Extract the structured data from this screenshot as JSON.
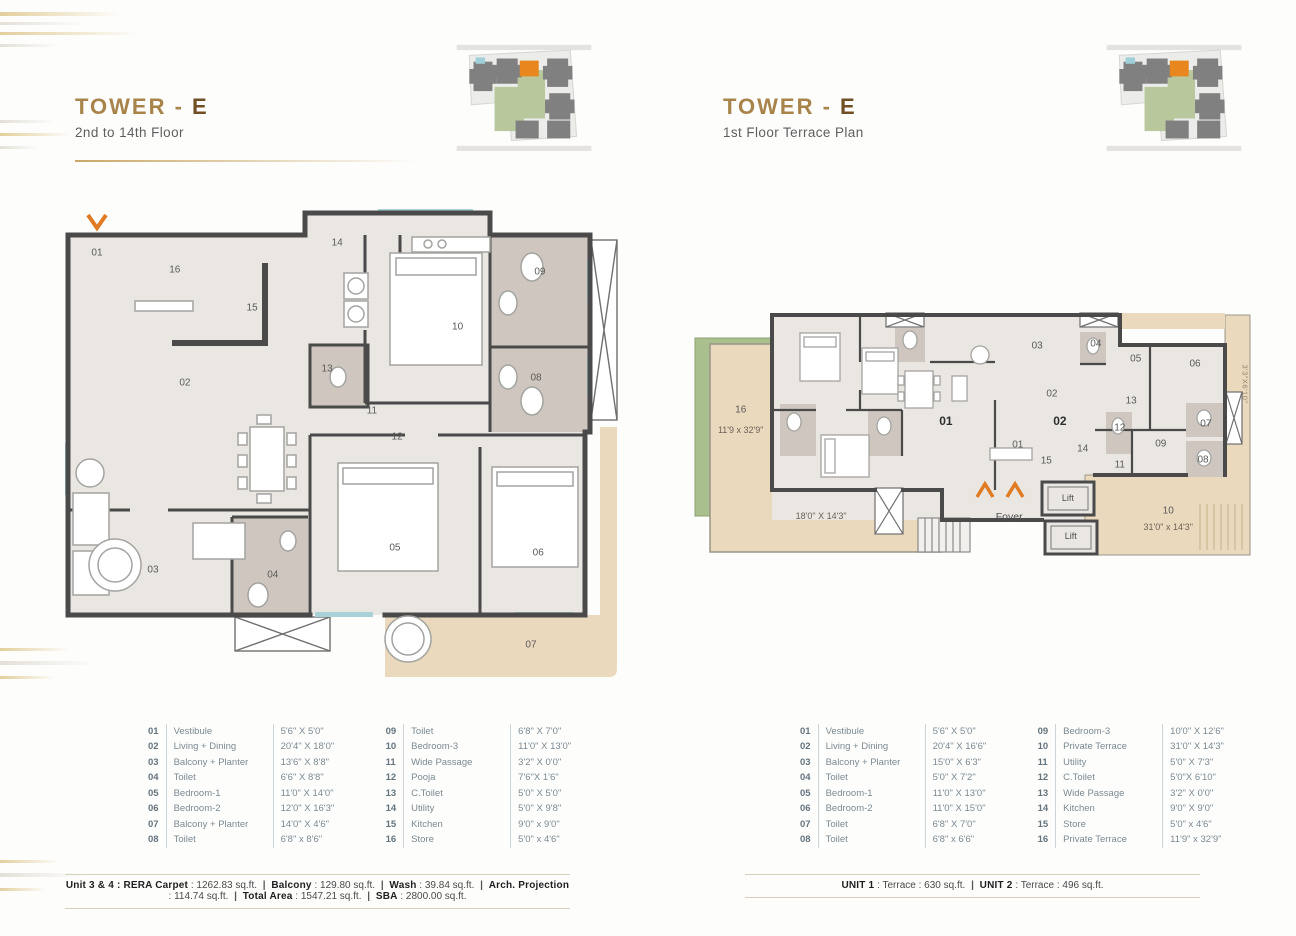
{
  "colors": {
    "accent_gold": "#a8834a",
    "tower_highlight_orange": "#e8871e",
    "entry_arrow_orange": "#e07b24",
    "terrace_beige": "#ebd9bd",
    "planter_green": "#a9bf8d",
    "toilet_taupe": "#cfc7bf",
    "wall_gray": "#4a4a4a"
  },
  "left": {
    "title": {
      "prefix": "TOWER - ",
      "tower": "E"
    },
    "subtitle": "2nd to 14th Floor",
    "plan_labels": [
      {
        "t": "01",
        "x": 6.6,
        "y": 9.8
      },
      {
        "t": "16",
        "x": 20.5,
        "y": 13.3
      },
      {
        "t": "15",
        "x": 34.3,
        "y": 21.0
      },
      {
        "t": "14",
        "x": 49.5,
        "y": 7.8
      },
      {
        "t": "10",
        "x": 71.0,
        "y": 24.9
      },
      {
        "t": "09",
        "x": 85.7,
        "y": 13.7
      },
      {
        "t": "08",
        "x": 85.0,
        "y": 35.3
      },
      {
        "t": "13",
        "x": 47.7,
        "y": 33.5
      },
      {
        "t": "02",
        "x": 22.3,
        "y": 36.3
      },
      {
        "t": "11",
        "x": 55.7,
        "y": 42.0
      },
      {
        "t": "12",
        "x": 60.2,
        "y": 47.3
      },
      {
        "t": "05",
        "x": 59.8,
        "y": 70.0
      },
      {
        "t": "06",
        "x": 85.4,
        "y": 71.0
      },
      {
        "t": "03",
        "x": 16.6,
        "y": 74.5
      },
      {
        "t": "04",
        "x": 38.0,
        "y": 75.5
      },
      {
        "t": "07",
        "x": 84.1,
        "y": 89.8
      }
    ],
    "legend": {
      "col1": [
        {
          "no": "01",
          "name": "Vestibule",
          "dim": "5'6\" X 5'0\""
        },
        {
          "no": "02",
          "name": "Living + Dining",
          "dim": "20'4\" X 18'0\""
        },
        {
          "no": "03",
          "name": "Balcony + Planter",
          "dim": "13'6\" X 8'8\""
        },
        {
          "no": "04",
          "name": "Toilet",
          "dim": "6'6\" X 8'8\""
        },
        {
          "no": "05",
          "name": "Bedroom-1",
          "dim": "11'0\" X 14'0\""
        },
        {
          "no": "06",
          "name": "Bedroom-2",
          "dim": "12'0\" X 16'3\""
        },
        {
          "no": "07",
          "name": "Balcony + Planter",
          "dim": "14'0\" X 4'6\""
        },
        {
          "no": "08",
          "name": "Toilet",
          "dim": "6'8\" x 8'6\""
        }
      ],
      "col2": [
        {
          "no": "09",
          "name": "Toilet",
          "dim": "6'8\" X 7'0\""
        },
        {
          "no": "10",
          "name": "Bedroom-3",
          "dim": "11'0\" X 13'0\""
        },
        {
          "no": "11",
          "name": "Wide Passage",
          "dim": "3'2\" X 0'0\""
        },
        {
          "no": "12",
          "name": "Pooja",
          "dim": "7'6\"X 1'6\""
        },
        {
          "no": "13",
          "name": "C.Toilet",
          "dim": "5'0\" X 5'0\""
        },
        {
          "no": "14",
          "name": "Utility",
          "dim": "5'0\" X 9'8\""
        },
        {
          "no": "15",
          "name": "Kitchen",
          "dim": "9'0\" x 9'0\""
        },
        {
          "no": "16",
          "name": "Store",
          "dim": "5'0\" x 4'6\""
        }
      ]
    },
    "footer": {
      "separator": "|",
      "items": [
        {
          "label": "Unit 3 & 4 : RERA Carpet",
          "value": ": 1262.83 sq.ft."
        },
        {
          "label": "Balcony",
          "value": ": 129.80 sq.ft."
        },
        {
          "label": "Wash",
          "value": ": 39.84 sq.ft."
        },
        {
          "label": "Arch. Projection",
          "value": ": 114.74 sq.ft."
        },
        {
          "label": "Total Area",
          "value": ": 1547.21 sq.ft."
        },
        {
          "label": "SBA",
          "value": ": 2800.00 sq.ft."
        }
      ]
    }
  },
  "right": {
    "title": {
      "prefix": "TOWER - ",
      "tower": "E"
    },
    "subtitle": "1st Floor Terrace Plan",
    "plan_labels": [
      {
        "t": "16",
        "x": 8.9,
        "y": 42.0
      },
      {
        "t": "11'9 x 32'9\"",
        "x": 8.9,
        "y": 49.5,
        "c": "dim"
      },
      {
        "t": "18'0\" X 14'3\"",
        "x": 23.0,
        "y": 82.5,
        "c": "dim"
      },
      {
        "t": "01",
        "x": 44.9,
        "y": 46.0,
        "c": "bold"
      },
      {
        "t": "02",
        "x": 64.9,
        "y": 46.0,
        "c": "bold"
      },
      {
        "t": "03",
        "x": 60.9,
        "y": 17.5
      },
      {
        "t": "04",
        "x": 71.2,
        "y": 16.8
      },
      {
        "t": "05",
        "x": 78.2,
        "y": 22.5
      },
      {
        "t": "06",
        "x": 88.6,
        "y": 24.5
      },
      {
        "t": "02",
        "x": 63.5,
        "y": 36.0
      },
      {
        "t": "13",
        "x": 77.4,
        "y": 38.5
      },
      {
        "t": "12",
        "x": 75.4,
        "y": 49.0
      },
      {
        "t": "09",
        "x": 82.6,
        "y": 55.0
      },
      {
        "t": "07",
        "x": 90.5,
        "y": 47.5
      },
      {
        "t": "08",
        "x": 90.0,
        "y": 61.0
      },
      {
        "t": "14",
        "x": 68.9,
        "y": 57.0
      },
      {
        "t": "11",
        "x": 75.4,
        "y": 63.0
      },
      {
        "t": "15",
        "x": 62.5,
        "y": 61.5
      },
      {
        "t": "01",
        "x": 57.5,
        "y": 55.5
      },
      {
        "t": "Foyer",
        "x": 56.0,
        "y": 82.8,
        "c": "foyer"
      },
      {
        "t": "Lift",
        "x": 66.3,
        "y": 75.6,
        "c": "lift"
      },
      {
        "t": "Lift",
        "x": 66.8,
        "y": 90.2,
        "c": "lift"
      },
      {
        "t": "10",
        "x": 83.9,
        "y": 80.5
      },
      {
        "t": "31'0\" x 14'3\"",
        "x": 83.9,
        "y": 86.5,
        "c": "dim"
      },
      {
        "t": "3'3\"X6'10\"",
        "x": 97.3,
        "y": 32.0,
        "c": "vert"
      }
    ],
    "legend": {
      "col1": [
        {
          "no": "01",
          "name": "Vestibule",
          "dim": "5'6\" X 5'0\""
        },
        {
          "no": "02",
          "name": "Living + Dining",
          "dim": "20'4\" X 16'6\""
        },
        {
          "no": "03",
          "name": "Balcony + Planter",
          "dim": "15'0\" X 6'3\""
        },
        {
          "no": "04",
          "name": "Toilet",
          "dim": "5'0\" X 7'2\""
        },
        {
          "no": "05",
          "name": "Bedroom-1",
          "dim": "11'0\" X 13'0\""
        },
        {
          "no": "06",
          "name": "Bedroom-2",
          "dim": "11'0\" X 15'0\""
        },
        {
          "no": "07",
          "name": "Toilet",
          "dim": "6'8\" X 7'0\""
        },
        {
          "no": "08",
          "name": "Toilet",
          "dim": "6'8\" x 6'6\""
        }
      ],
      "col2": [
        {
          "no": "09",
          "name": "Bedroom-3",
          "dim": "10'0\" X 12'6\""
        },
        {
          "no": "10",
          "name": "Private Terrace",
          "dim": "31'0\" X 14'3\""
        },
        {
          "no": "11",
          "name": "Utility",
          "dim": "5'0\" X 7'3\""
        },
        {
          "no": "12",
          "name": "C.Toilet",
          "dim": "5'0\"X 6'10\""
        },
        {
          "no": "13",
          "name": "Wide Passage",
          "dim": "3'2\" X 0'0\""
        },
        {
          "no": "14",
          "name": "Kitchen",
          "dim": "9'0\" X 9'0\""
        },
        {
          "no": "15",
          "name": "Store",
          "dim": "5'0\" x 4'6\""
        },
        {
          "no": "16",
          "name": "Private Terrace",
          "dim": "11'9\" x 32'9\""
        }
      ]
    },
    "footer": {
      "separator": "|",
      "items": [
        {
          "label": "UNIT 1",
          "value": ": Terrace : 630 sq.ft."
        },
        {
          "label": "UNIT 2",
          "value": ": Terrace : 496 sq.ft."
        }
      ]
    }
  }
}
